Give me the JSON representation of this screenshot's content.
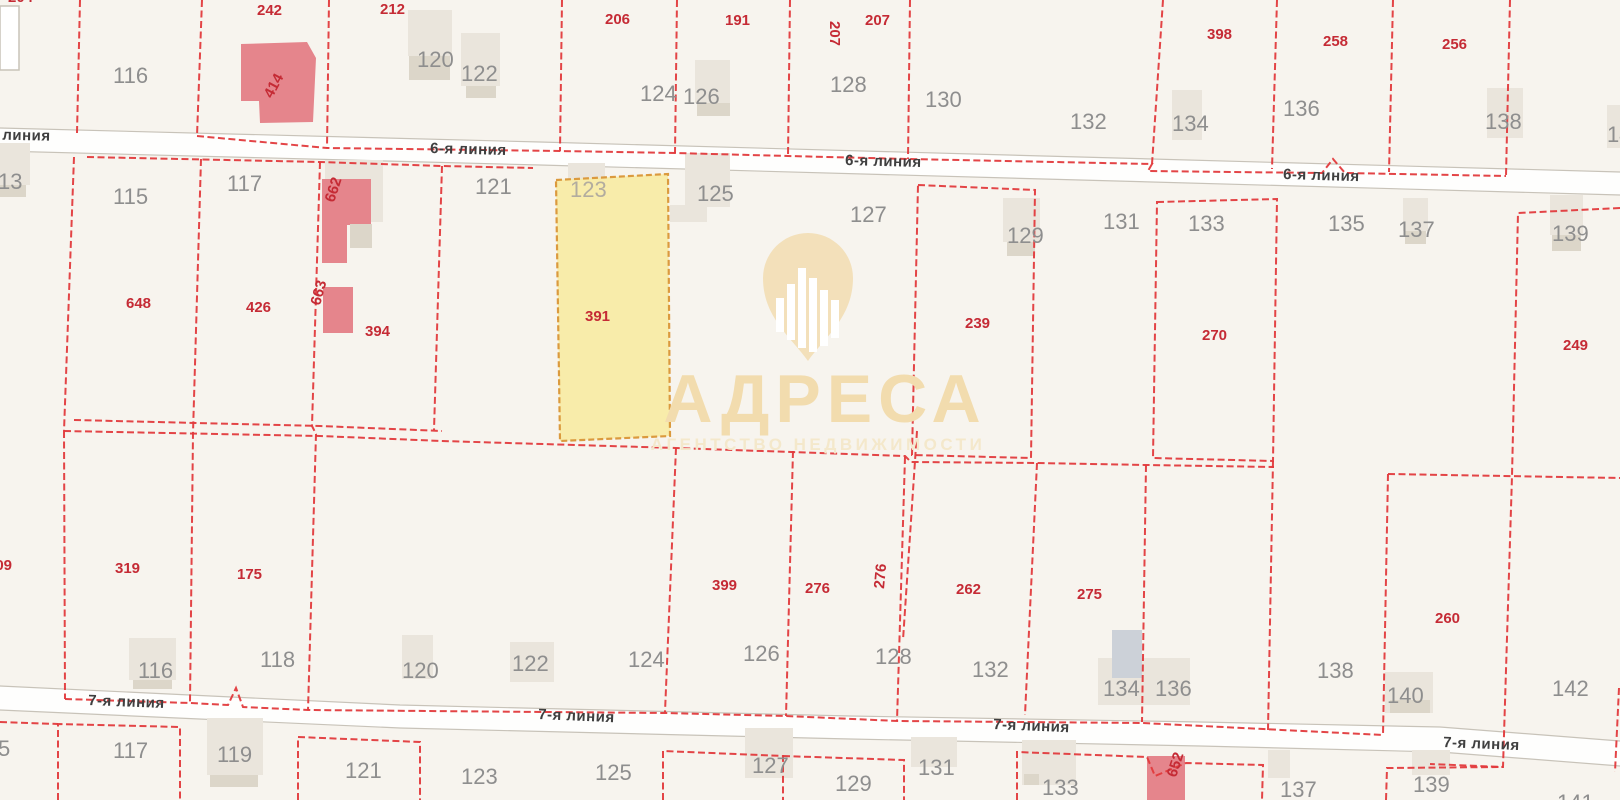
{
  "map": {
    "background": "#f7f4ee",
    "colors": {
      "boundary_red": "#e23a3c",
      "parcel_number_red": "#c52b35",
      "address_gray": "#8e8e8e",
      "address_faint": "#b2ac9f",
      "street_fill": "#fefefd",
      "street_edge": "#c8c3b9",
      "street_text": "#3f3f3f",
      "building_light": "#eae5dc",
      "building_shadow": "#dcd6c9",
      "building_white": "#ffffff",
      "building_pink": "#e5858c",
      "building_blue": "#ccd1d8",
      "selected_fill": "#f8eba1",
      "selected_stroke": "#db9a3e",
      "watermark_gold": "#f2dcae",
      "watermark_gold_faint": "#f4e8cb",
      "watermark_pin": "#f3e0ba"
    },
    "streets": [
      {
        "name": "6-я линия",
        "band_top": "0,128 540,142 1080,157 1620,172",
        "band_bottom": "0,151 540,165 1080,180 1620,195",
        "labels": [
          {
            "x": -26,
            "y": 126,
            "rot": 1.3
          },
          {
            "x": 430,
            "y": 140,
            "rot": 1.5
          },
          {
            "x": 845,
            "y": 152,
            "rot": 1.5
          },
          {
            "x": 1283,
            "y": 166,
            "rot": 1.6
          }
        ]
      },
      {
        "name": "7-я линия",
        "band_top": "0,686 400,705 850,716 1200,722 1440,727 1620,741",
        "band_bottom": "0,710 400,728 850,739 1200,746 1440,752 1620,766",
        "labels": [
          {
            "x": 88,
            "y": 692,
            "rot": 2.2
          },
          {
            "x": 538,
            "y": 706,
            "rot": 2.4
          },
          {
            "x": 993,
            "y": 716,
            "rot": 2.4
          },
          {
            "x": 1443,
            "y": 734,
            "rot": 2.3
          }
        ]
      }
    ],
    "boundaries": [
      {
        "points": "80,0 77,133"
      },
      {
        "points": "202,0 197,136"
      },
      {
        "points": "197,136 327,148 560,151 675,153 788,156 908,159 1152,164 1148,171 1322,173 1333,159 1345,173 1506,176"
      },
      {
        "points": "329,0 327,148"
      },
      {
        "points": "562,0 560,151"
      },
      {
        "points": "677,0 675,153"
      },
      {
        "points": "790,0 788,156"
      },
      {
        "points": "910,0 908,159"
      },
      {
        "points": "1163,0 1152,164"
      },
      {
        "points": "1277,0 1272,169"
      },
      {
        "points": "1393,0 1389,172"
      },
      {
        "points": "1510,0 1506,176"
      },
      {
        "points": "87,157 320,162 442,166 533,168"
      },
      {
        "points": "74,157 64,431"
      },
      {
        "points": "201,159 193,433 190,702"
      },
      {
        "points": "320,162 312,426 316,434 308,710"
      },
      {
        "points": "442,166 434,430"
      },
      {
        "points": "74,420 320,426 442,431"
      },
      {
        "points": "64,431 320,436 442,441 676,448 905,456 911,462 1037,463 1146,465 1274,467"
      },
      {
        "points": "64,431 65,699"
      },
      {
        "points": "65,699 190,703 228,705 236,688 243,707 308,710 665,713 786,716 898,721 1142,723 1383,735"
      },
      {
        "points": "676,448 665,712"
      },
      {
        "points": "793,451 786,716"
      },
      {
        "points": "905,457 897,721"
      },
      {
        "points": "917,431 903,640"
      },
      {
        "points": "1037,463 1025,715"
      },
      {
        "points": "1146,465 1142,722"
      },
      {
        "points": "1273,461 1268,730"
      },
      {
        "points": "1620,208 1518,213 1512,476 1503,767 1430,764"
      },
      {
        "points": "1388,474 1620,478"
      },
      {
        "points": "1388,474 1383,735"
      },
      {
        "points": "0,722 58,724"
      },
      {
        "points": "58,800 58,724 180,727 180,800"
      },
      {
        "points": "298,800 298,737 420,742 420,800"
      },
      {
        "points": "663,800 663,751 783,756 783,800"
      },
      {
        "points": "783,756 904,760 904,800"
      },
      {
        "points": "1017,800 1017,752 1147,757 1155,776 1186,763 1263,765 1262,800"
      },
      {
        "points": "1386,800 1387,768 1503,767"
      },
      {
        "points": "1619,688 1615,772"
      }
    ],
    "parcel_boxes": [
      {
        "points": "918,185 1035,190 1031,458 912,455"
      },
      {
        "points": "1157,202 1277,199 1273,461 1153,458"
      }
    ],
    "selected_parcel": {
      "points": "556,180 668,174 670,436 560,441",
      "number": "391",
      "address": "123",
      "number_pos": {
        "x": 585,
        "y": 308
      },
      "address_pos": {
        "x": 570,
        "y": 178
      }
    },
    "buildings": [
      {
        "type": "white",
        "x": 0,
        "y": 6,
        "w": 19,
        "h": 64
      },
      {
        "type": "pink",
        "path": "M241,44 L307,42 L316,58 L313,122 L260,123 L259,101 L241,101 Z"
      },
      {
        "type": "light",
        "x": 408,
        "y": 10,
        "w": 44,
        "h": 46
      },
      {
        "type": "shadow",
        "x": 409,
        "y": 56,
        "w": 41,
        "h": 24
      },
      {
        "type": "light",
        "x": 461,
        "y": 33,
        "w": 39,
        "h": 53
      },
      {
        "type": "shadow",
        "x": 466,
        "y": 86,
        "w": 30,
        "h": 12
      },
      {
        "type": "light",
        "x": 695,
        "y": 60,
        "w": 35,
        "h": 43
      },
      {
        "type": "shadow",
        "x": 697,
        "y": 103,
        "w": 33,
        "h": 13
      },
      {
        "type": "light",
        "x": 1172,
        "y": 90,
        "w": 30,
        "h": 50
      },
      {
        "type": "light",
        "x": 1487,
        "y": 88,
        "w": 36,
        "h": 50
      },
      {
        "type": "light",
        "x": 1607,
        "y": 105,
        "w": 13,
        "h": 43
      },
      {
        "type": "light",
        "x": 0,
        "y": 143,
        "w": 30,
        "h": 42
      },
      {
        "type": "shadow",
        "x": 0,
        "y": 185,
        "w": 26,
        "h": 12
      },
      {
        "type": "light",
        "x": 325,
        "y": 160,
        "w": 58,
        "h": 62
      },
      {
        "type": "pink",
        "path": "M322,179 L371,179 L371,225 L347,225 L347,263 L322,263 Z"
      },
      {
        "type": "shadow",
        "x": 350,
        "y": 224,
        "w": 22,
        "h": 24
      },
      {
        "type": "pink",
        "x": 323,
        "y": 287,
        "w": 30,
        "h": 46
      },
      {
        "type": "light",
        "x": 568,
        "y": 163,
        "w": 37,
        "h": 17
      },
      {
        "type": "light",
        "x": 685,
        "y": 153,
        "w": 45,
        "h": 54
      },
      {
        "type": "light",
        "x": 670,
        "y": 205,
        "w": 37,
        "h": 17
      },
      {
        "type": "light",
        "x": 1003,
        "y": 198,
        "w": 37,
        "h": 44
      },
      {
        "type": "shadow",
        "x": 1007,
        "y": 242,
        "w": 28,
        "h": 14
      },
      {
        "type": "light",
        "x": 1403,
        "y": 198,
        "w": 25,
        "h": 33
      },
      {
        "type": "shadow",
        "x": 1405,
        "y": 231,
        "w": 21,
        "h": 13
      },
      {
        "type": "light",
        "x": 1550,
        "y": 195,
        "w": 33,
        "h": 40
      },
      {
        "type": "shadow",
        "x": 1552,
        "y": 235,
        "w": 29,
        "h": 16
      },
      {
        "type": "light",
        "x": 129,
        "y": 638,
        "w": 47,
        "h": 42
      },
      {
        "type": "shadow",
        "x": 133,
        "y": 680,
        "w": 39,
        "h": 9
      },
      {
        "type": "light",
        "x": 402,
        "y": 635,
        "w": 31,
        "h": 44
      },
      {
        "type": "light",
        "x": 510,
        "y": 642,
        "w": 44,
        "h": 40
      },
      {
        "type": "light",
        "x": 1098,
        "y": 658,
        "w": 92,
        "h": 47
      },
      {
        "type": "blue",
        "x": 1112,
        "y": 630,
        "w": 30,
        "h": 48
      },
      {
        "type": "light",
        "x": 1385,
        "y": 672,
        "w": 48,
        "h": 41
      },
      {
        "type": "shadow",
        "x": 1390,
        "y": 700,
        "w": 40,
        "h": 13
      },
      {
        "type": "light",
        "x": 207,
        "y": 718,
        "w": 56,
        "h": 57
      },
      {
        "type": "shadow",
        "x": 210,
        "y": 775,
        "w": 48,
        "h": 12
      },
      {
        "type": "light",
        "x": 745,
        "y": 728,
        "w": 48,
        "h": 50
      },
      {
        "type": "light",
        "x": 911,
        "y": 737,
        "w": 46,
        "h": 30
      },
      {
        "type": "light",
        "x": 1022,
        "y": 740,
        "w": 54,
        "h": 45
      },
      {
        "type": "shadow",
        "x": 1024,
        "y": 774,
        "w": 15,
        "h": 11
      },
      {
        "type": "light",
        "x": 1268,
        "y": 750,
        "w": 22,
        "h": 28
      },
      {
        "type": "light",
        "x": 1412,
        "y": 750,
        "w": 38,
        "h": 25
      },
      {
        "type": "pink",
        "x": 1147,
        "y": 756,
        "w": 38,
        "h": 44
      }
    ],
    "parcel_numbers_red": [
      {
        "text": "204",
        "x": 8,
        "y": -11
      },
      {
        "text": "242",
        "x": 257,
        "y": 2
      },
      {
        "text": "212",
        "x": 380,
        "y": 1
      },
      {
        "text": "206",
        "x": 605,
        "y": 11
      },
      {
        "text": "191",
        "x": 725,
        "y": 12
      },
      {
        "text": "207",
        "x": 830,
        "y": 8,
        "rot": 90
      },
      {
        "text": "207",
        "x": 865,
        "y": 12
      },
      {
        "text": "398",
        "x": 1207,
        "y": 26
      },
      {
        "text": "258",
        "x": 1323,
        "y": 33
      },
      {
        "text": "256",
        "x": 1442,
        "y": 36
      },
      {
        "text": "414",
        "x": 272,
        "y": 86,
        "rot": -62
      },
      {
        "text": "648",
        "x": 126,
        "y": 295
      },
      {
        "text": "426",
        "x": 246,
        "y": 299
      },
      {
        "text": "662",
        "x": 334,
        "y": 190,
        "rot": -72
      },
      {
        "text": "663",
        "x": 320,
        "y": 293,
        "rot": -75
      },
      {
        "text": "394",
        "x": 365,
        "y": 323
      },
      {
        "text": "239",
        "x": 965,
        "y": 315
      },
      {
        "text": "270",
        "x": 1202,
        "y": 327
      },
      {
        "text": "249",
        "x": 1563,
        "y": 337
      },
      {
        "text": "309",
        "x": -13,
        "y": 557
      },
      {
        "text": "319",
        "x": 115,
        "y": 560
      },
      {
        "text": "175",
        "x": 237,
        "y": 566
      },
      {
        "text": "399",
        "x": 712,
        "y": 577
      },
      {
        "text": "276",
        "x": 805,
        "y": 580
      },
      {
        "text": "276",
        "x": 884,
        "y": 576,
        "rot": -85
      },
      {
        "text": "262",
        "x": 956,
        "y": 581
      },
      {
        "text": "275",
        "x": 1077,
        "y": 586
      },
      {
        "text": "260",
        "x": 1435,
        "y": 610
      },
      {
        "text": "652",
        "x": 1176,
        "y": 765,
        "rot": -72
      }
    ],
    "address_numbers_gray": [
      {
        "text": "116",
        "x": 113,
        "y": 64
      },
      {
        "text": "120",
        "x": 417,
        "y": 48
      },
      {
        "text": "122",
        "x": 461,
        "y": 62
      },
      {
        "text": "124",
        "x": 640,
        "y": 82
      },
      {
        "text": "126",
        "x": 683,
        "y": 85
      },
      {
        "text": "128",
        "x": 830,
        "y": 73
      },
      {
        "text": "130",
        "x": 925,
        "y": 88
      },
      {
        "text": "132",
        "x": 1070,
        "y": 110
      },
      {
        "text": "134",
        "x": 1172,
        "y": 112
      },
      {
        "text": "136",
        "x": 1283,
        "y": 97
      },
      {
        "text": "138",
        "x": 1485,
        "y": 110
      },
      {
        "text": "14",
        "x": 1607,
        "y": 123
      },
      {
        "text": "13",
        "x": -2,
        "y": 170
      },
      {
        "text": "115",
        "x": 113,
        "y": 185
      },
      {
        "text": "117",
        "x": 227,
        "y": 172
      },
      {
        "text": "121",
        "x": 475,
        "y": 175
      },
      {
        "text": "125",
        "x": 697,
        "y": 182
      },
      {
        "text": "127",
        "x": 850,
        "y": 203
      },
      {
        "text": "129",
        "x": 1007,
        "y": 224
      },
      {
        "text": "131",
        "x": 1103,
        "y": 210
      },
      {
        "text": "133",
        "x": 1188,
        "y": 212
      },
      {
        "text": "135",
        "x": 1328,
        "y": 212
      },
      {
        "text": "137",
        "x": 1398,
        "y": 218
      },
      {
        "text": "139",
        "x": 1552,
        "y": 222
      },
      {
        "text": "116",
        "x": 138,
        "y": 659
      },
      {
        "text": "118",
        "x": 260,
        "y": 648
      },
      {
        "text": "120",
        "x": 402,
        "y": 659
      },
      {
        "text": "122",
        "x": 512,
        "y": 652
      },
      {
        "text": "124",
        "x": 628,
        "y": 648
      },
      {
        "text": "126",
        "x": 743,
        "y": 642
      },
      {
        "text": "128",
        "x": 875,
        "y": 645
      },
      {
        "text": "132",
        "x": 972,
        "y": 658
      },
      {
        "text": "134",
        "x": 1103,
        "y": 677
      },
      {
        "text": "136",
        "x": 1155,
        "y": 677
      },
      {
        "text": "138",
        "x": 1317,
        "y": 659
      },
      {
        "text": "140",
        "x": 1387,
        "y": 684
      },
      {
        "text": "142",
        "x": 1552,
        "y": 677
      },
      {
        "text": "117",
        "x": 113,
        "y": 739
      },
      {
        "text": "119",
        "x": 217,
        "y": 743
      },
      {
        "text": "121",
        "x": 345,
        "y": 759
      },
      {
        "text": "123",
        "x": 461,
        "y": 765
      },
      {
        "text": "125",
        "x": 595,
        "y": 761
      },
      {
        "text": "127",
        "x": 752,
        "y": 754
      },
      {
        "text": "129",
        "x": 835,
        "y": 772
      },
      {
        "text": "131",
        "x": 918,
        "y": 756
      },
      {
        "text": "133",
        "x": 1042,
        "y": 776
      },
      {
        "text": "137",
        "x": 1280,
        "y": 778
      },
      {
        "text": "139",
        "x": 1413,
        "y": 773
      },
      {
        "text": "141",
        "x": 1557,
        "y": 791
      },
      {
        "text": "5",
        "x": -2,
        "y": 737
      }
    ],
    "watermark": {
      "brand": "АДРЕСА",
      "subtitle": "АГЕНТСТВО НЕДВИЖИМОСТИ"
    }
  }
}
